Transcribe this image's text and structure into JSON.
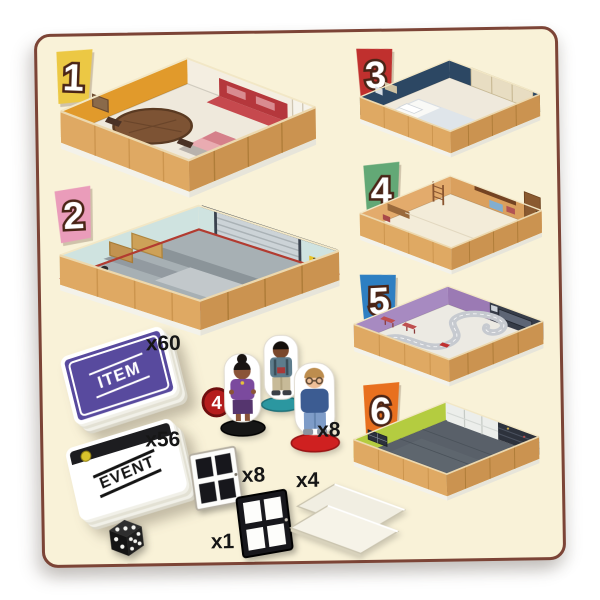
{
  "board": {
    "bg": "#f9f2d8"
  },
  "palette": {
    "wood": "#dfa963",
    "wood_shade": "#cb9350",
    "base": "#f3f2ea",
    "base_shade": "#e7e5da"
  },
  "badges": [
    {
      "number": "1",
      "color": "#ecc844"
    },
    {
      "number": "2",
      "color": "#ea9cba"
    },
    {
      "number": "3",
      "color": "#c0302e"
    },
    {
      "number": "4",
      "color": "#63a876"
    },
    {
      "number": "5",
      "color": "#2e7fc2"
    },
    {
      "number": "6",
      "color": "#e8701f"
    }
  ],
  "rooms": [
    {
      "id": "living-room",
      "colors": {
        "wall_left": "#e19a2b",
        "wall_right": "#f4eee1",
        "floor": "#efe9dc",
        "sofa": "#b5373c",
        "bed": "#e9abb1"
      }
    },
    {
      "id": "garage",
      "colors": {
        "wall_left": "#cfe3e0",
        "wall_right": "#cfe3e0",
        "floor": "#a7b0b4",
        "trim": "#b23b30",
        "hazard": "#e9c227"
      }
    },
    {
      "id": "bedroom",
      "colors": {
        "wall_left": "#2c4763",
        "wall_right": "#2c4763",
        "floor": "#efe9dc",
        "curtain": "#e8ddc2"
      }
    },
    {
      "id": "study",
      "colors": {
        "wall_left": "#e3ab6c",
        "wall_right": "#daa05e",
        "floor": "#f3ecd9"
      }
    },
    {
      "id": "playroom",
      "colors": {
        "wall_left": "#a78ac1",
        "wall_right": "#9b7ab4",
        "floor": "#eceae3",
        "media": "#363c48"
      }
    },
    {
      "id": "kitchen",
      "colors": {
        "wall_left": "#b4cc40",
        "wall_right": "#eceeeb",
        "floor": "#596069",
        "pantry": "#2d323c"
      }
    }
  ],
  "decks": {
    "item": {
      "label": "ITEM",
      "count": "x60",
      "color": "#584a9e"
    },
    "event": {
      "label": "EVENT",
      "count": "x56"
    }
  },
  "characters": {
    "count": "x8",
    "quantity_badge": "4",
    "badge_color": "#b51d1d"
  },
  "windows": {
    "white": {
      "count": "x8"
    },
    "black": {
      "count": "x1"
    }
  },
  "floor_tiles": {
    "count": "x4"
  },
  "die": {
    "pips_top": 3,
    "pips_left": 2,
    "pips_right": 5
  }
}
